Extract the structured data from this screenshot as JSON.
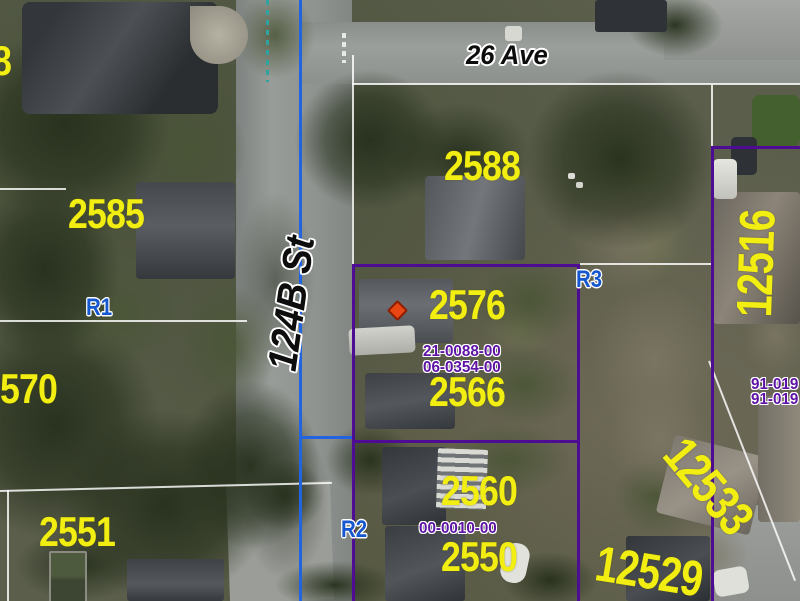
{
  "map_labels": {
    "streets": {
      "ave_26": "26 Ave",
      "st_124b": "124B St"
    },
    "addresses": {
      "partial_top_left": "8",
      "a2585": "2585",
      "a2588": "2588",
      "a2576": "2576",
      "a2566": "2566",
      "a2560": "2560",
      "a2550": "2550",
      "a2551": "2551",
      "partial_mid_left": "570",
      "a12516": "12516",
      "a12533": "12533",
      "a12529": "12529"
    },
    "zoning": {
      "r1": "R1",
      "r2": "R2",
      "r3": "R3"
    },
    "permits": {
      "p1": "21-0088-00",
      "p2": "06-0354-00",
      "p3": "00-0010-00",
      "right_1": "91-019",
      "right_2": "91-019"
    }
  },
  "legend_colors": {
    "address_text": "#f2ee12",
    "zoning_text": "#1557cf",
    "permit_text": "#5e12a6",
    "parcel_boundary": "#4e0b93",
    "street_centerline": "#2264e0",
    "dashed_utility_line": "#2fa3a0",
    "poi_marker": "#e84612"
  },
  "markers": {
    "poi": {
      "shape": "diamond",
      "x": 396,
      "y": 310
    }
  }
}
